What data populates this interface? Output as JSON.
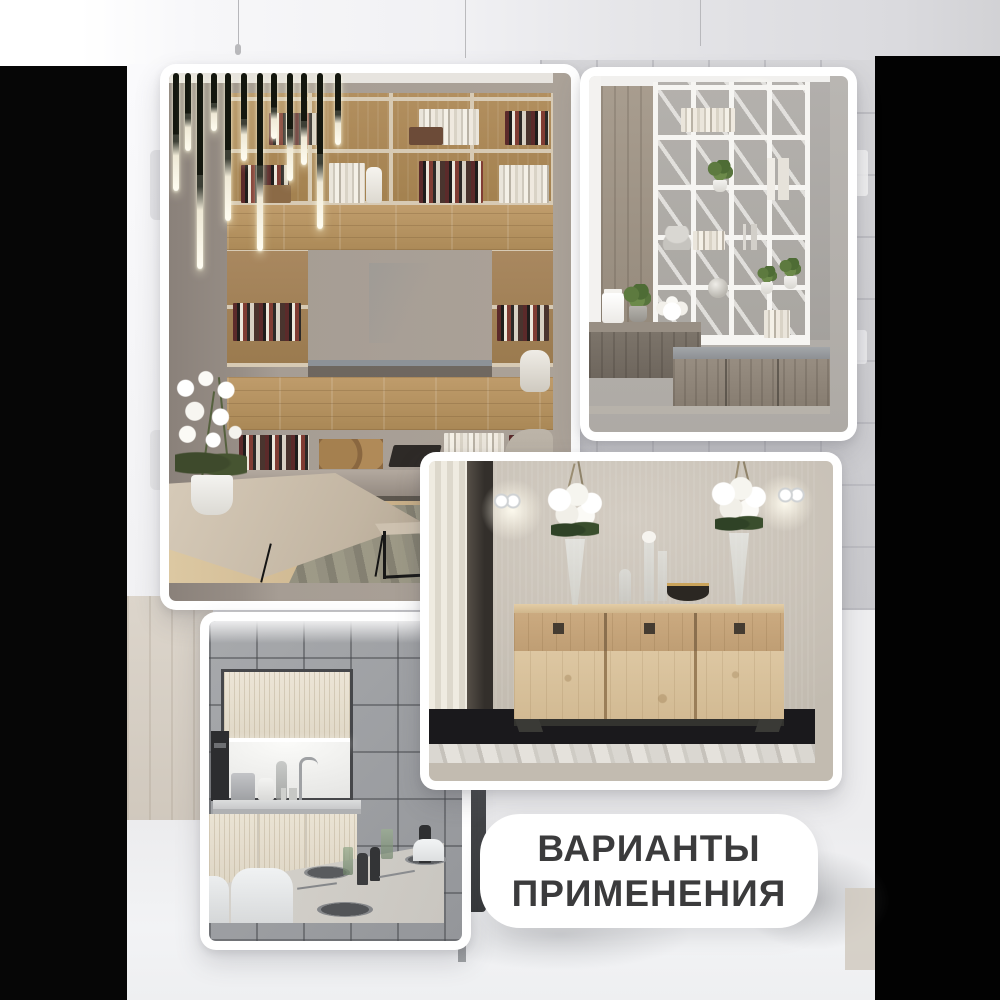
{
  "poster": {
    "caption": {
      "line1": "ВАРИАНТЫ",
      "line2": "ПРИМЕНЕНИЯ",
      "text_color": "#3b3b3c",
      "card_color": "#ffffff"
    },
    "background": {
      "side_bars_color": "#030303",
      "backdrop_color": "#ededef"
    },
    "photos": [
      {
        "name": "living-room-tv-wall-unit"
      },
      {
        "name": "white-shelving-room-divider"
      },
      {
        "name": "oak-sideboard-with-roses"
      },
      {
        "name": "grey-kitchen-dining"
      }
    ]
  }
}
